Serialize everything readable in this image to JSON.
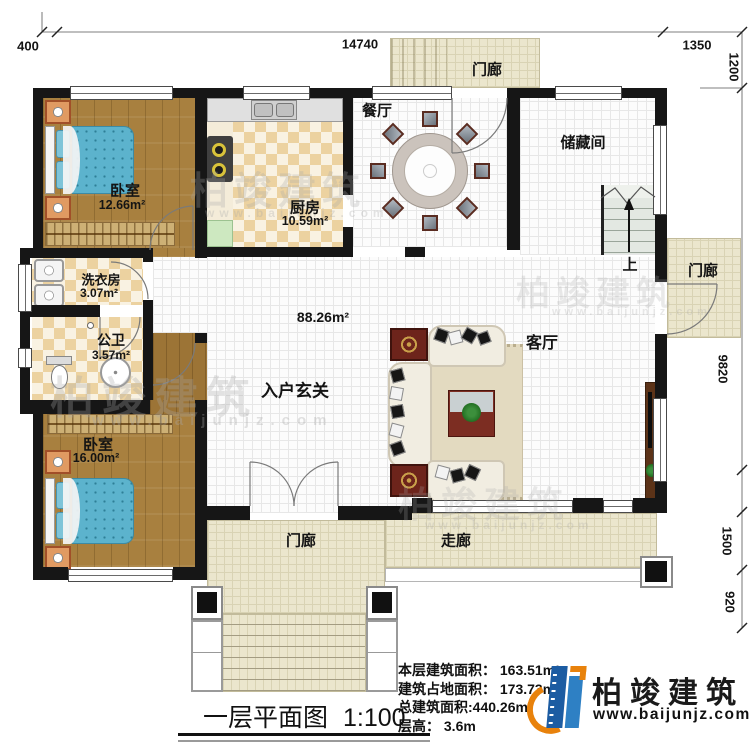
{
  "dimensions": {
    "top": [
      "400",
      "14740",
      "1350"
    ],
    "right": [
      "1200",
      "9820",
      "1500",
      "920"
    ]
  },
  "rooms": {
    "bedroom1": {
      "name": "卧室",
      "area": "12.66m²"
    },
    "kitchen": {
      "name": "厨房",
      "area": "10.59m²"
    },
    "dining": {
      "name": "餐厅"
    },
    "storage": {
      "name": "储藏间"
    },
    "laundry": {
      "name": "洗衣房",
      "area": "3.07m²"
    },
    "bathroom": {
      "name": "公卫",
      "area": "3.57m²"
    },
    "bedroom2": {
      "name": "卧室",
      "area": "16.00m²"
    },
    "foyer": {
      "name": "入户玄关"
    },
    "open_area": {
      "area": "88.26m²"
    },
    "living": {
      "name": "客厅"
    },
    "corridor": {
      "name": "走廊"
    },
    "porch_top": {
      "name": "门廊"
    },
    "porch_right": {
      "name": "门廊"
    },
    "porch_bottom": {
      "name": "门廊"
    },
    "stairs": {
      "direction": "上"
    }
  },
  "title": {
    "text": "一层平面图",
    "scale": "1:100"
  },
  "stats": {
    "floor_area": "本层建筑面积： 163.51m²",
    "footprint_area": "建筑占地面积： 173.73m²",
    "total_area": "总建筑面积:440.26m²",
    "floor_height": "层高： 3.6m"
  },
  "branding": {
    "logo_text": "柏竣建筑",
    "website": "www.baijunjz.com"
  },
  "watermark": {
    "text": "柏竣建筑",
    "url": "www.baijunjz.com"
  }
}
